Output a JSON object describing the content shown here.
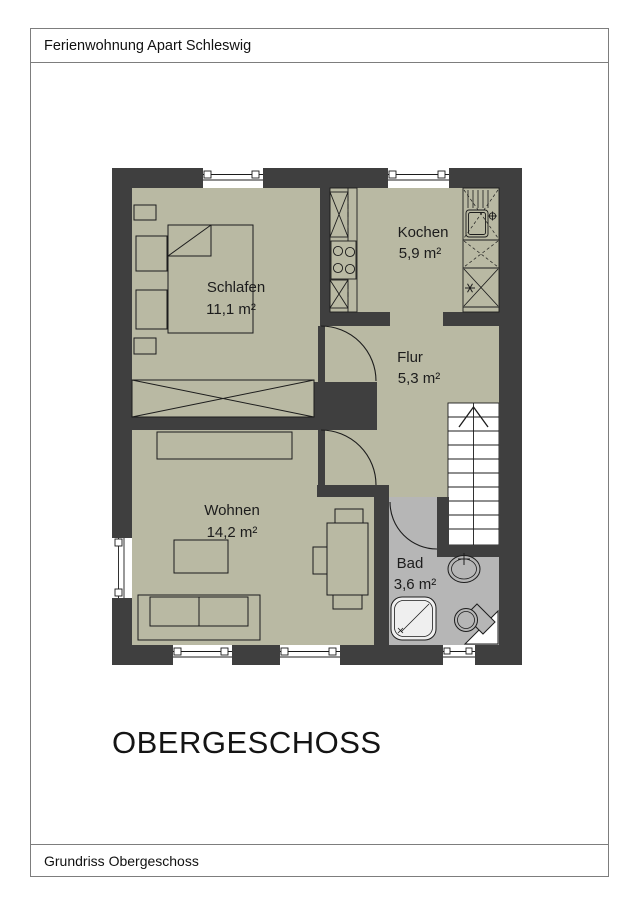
{
  "header": {
    "title": "Ferienwohnung Apart Schleswig"
  },
  "footer": {
    "label": "Grundriss Obergeschoss"
  },
  "plan": {
    "floor_label": "OBERGESCHOSS",
    "rooms": [
      {
        "id": "schlafen",
        "name": "Schlafen",
        "area": "11,1 m²"
      },
      {
        "id": "kochen",
        "name": "Kochen",
        "area": "5,9 m²"
      },
      {
        "id": "flur",
        "name": "Flur",
        "area": "5,3 m²"
      },
      {
        "id": "wohnen",
        "name": "Wohnen",
        "area": "14,2 m²"
      },
      {
        "id": "bad",
        "name": "Bad",
        "area": "3,6 m²"
      }
    ],
    "colors": {
      "wall": "#3f3f3f",
      "floor": "#b9b9a3",
      "bath_floor": "#b6b6b6",
      "stairs": "#ffffff",
      "line": "#1c1c1c"
    }
  }
}
